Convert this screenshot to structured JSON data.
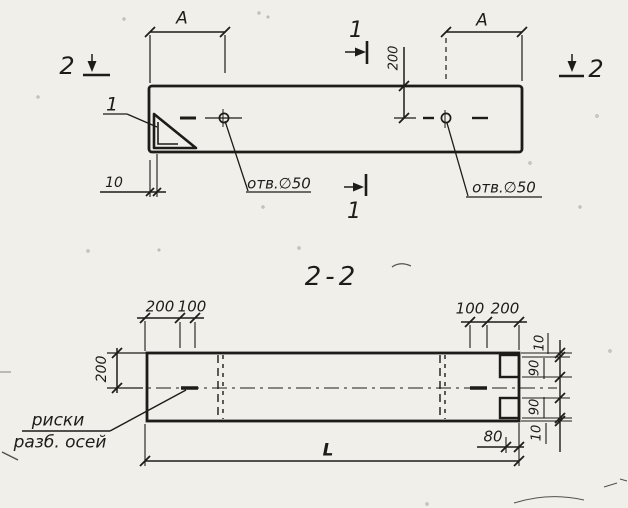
{
  "colors": {
    "ink": "#1d1c18",
    "paper": "#f1efea"
  },
  "top_view": {
    "dim_a_left": "A",
    "dim_a_right": "A",
    "dim_depth_200": "200",
    "dim_10": "10",
    "hole_note_left": "отв.∅50",
    "hole_note_right": "отв.∅50",
    "cut_1_top": "1",
    "cut_1_bottom": "1",
    "cut_2_left": "2",
    "cut_2_right": "2",
    "detail_callout": "1"
  },
  "section_view": {
    "title": "2-2",
    "dims_top_left": [
      "200",
      "100"
    ],
    "dims_top_right": [
      "100",
      "200"
    ],
    "dim_side_200": "200",
    "chain_right": [
      "10",
      "90",
      "90",
      "10"
    ],
    "dim_80": "80",
    "dim_length": "L",
    "note_line1": "риски",
    "note_line2": "разб. осей"
  }
}
